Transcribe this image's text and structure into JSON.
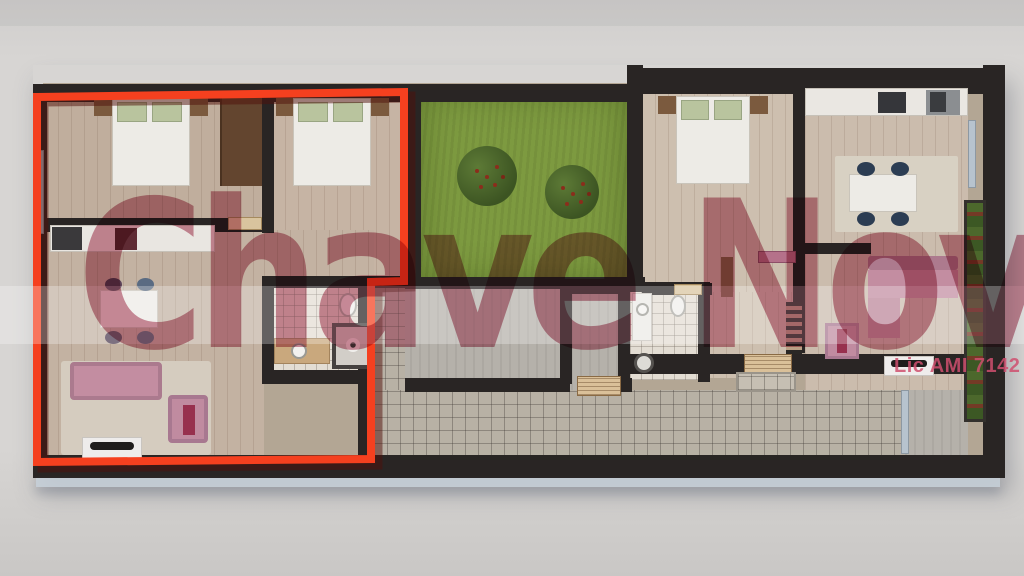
{
  "watermark": {
    "text": "Chave Nova",
    "color": "#a8334f"
  },
  "license": {
    "text": "Lic AMI 7142",
    "color": "#cf4f6e"
  },
  "floor_plan": {
    "highlighted_unit_outline_color": "#f5401f",
    "wall_color": "#292524",
    "garden_color": "#7d9a40",
    "walkway_tile_color": "#b8b1a5",
    "sofa_color": "#c38da1",
    "background_color": "#d5d3d1"
  }
}
